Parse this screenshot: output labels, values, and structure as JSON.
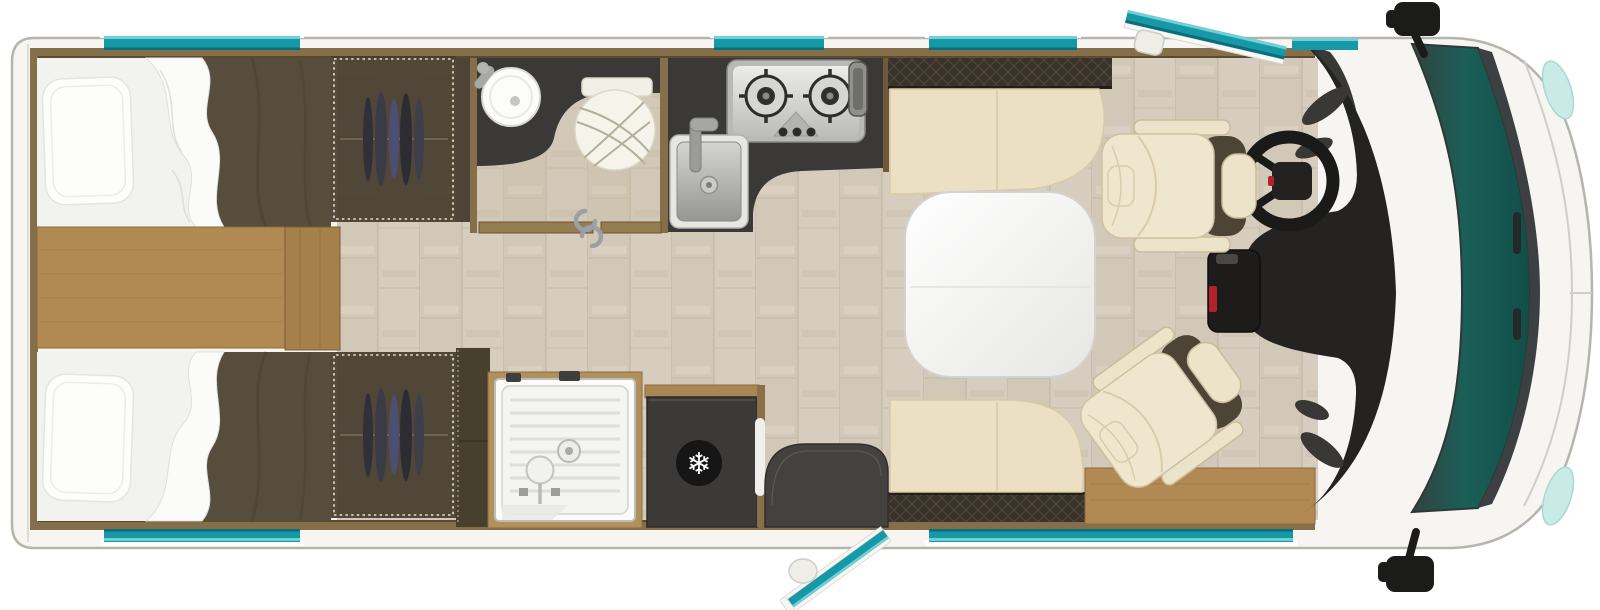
{
  "app": {
    "name": "motorhome-floorplan-top-view",
    "description": "top-view-floor-plan-of-a-motorhome"
  },
  "icons": {
    "fridge_snowflake": "❄"
  },
  "palette": {
    "body": "#f6f5f1",
    "outline": "#b5b5ae",
    "window_teal": "#1698a6",
    "window_teal_light": "#6fd0d6",
    "window_teal_dark": "#0b6d79",
    "glass_corner": "#c9ebe7",
    "windshield": "#1a5f58",
    "windshield_edge": "#3c4042",
    "wall_wood": "#846f4a",
    "wall_wood_dark": "#5c4a2f",
    "floor": "#d6cdbf",
    "floor_line": "#c2b6a2",
    "platform": "#b08953",
    "tan_trim": "#8d6b3c",
    "counter": "#3a3938",
    "steel": "#bcbcba",
    "cream": "#ebe0c3",
    "cream_seam": "#d9c9a6",
    "hatch": "#39322a",
    "duvet": "#574d3c",
    "wardrobe": "#443c2e",
    "dash": "#242321",
    "accent_red": "#b3222b",
    "table": "#f8f8f6",
    "fridge": "#3b3a38",
    "mat": "#44423f"
  },
  "zones": {
    "rear_bedroom": {
      "label": "twin-single-beds",
      "fixtures": [
        "bed",
        "pillow",
        "duvet",
        "wardrobe",
        "bedside-platform"
      ]
    },
    "washroom": {
      "label": "washroom",
      "fixtures": [
        "washbasin",
        "toilet",
        "sliding-door"
      ]
    },
    "kitchen": {
      "label": "kitchen",
      "fixtures": [
        "two-burner-hob",
        "kitchen-sink",
        "worktop"
      ]
    },
    "shower_room": {
      "label": "shower",
      "fixtures": [
        "shower-tray",
        "shower-mixer"
      ]
    },
    "galley_lower": {
      "label": "entry",
      "fixtures": [
        "refrigerator",
        "entrance-door",
        "entry-mat"
      ]
    },
    "dinette": {
      "label": "dinette",
      "fixtures": [
        "bench-seat-front",
        "bench-seat-rear",
        "table"
      ]
    },
    "cab": {
      "label": "driver-cab",
      "fixtures": [
        "driver-seat",
        "passenger-seat",
        "steering-wheel",
        "dashboard",
        "windshield",
        "side-mirrors"
      ]
    }
  }
}
